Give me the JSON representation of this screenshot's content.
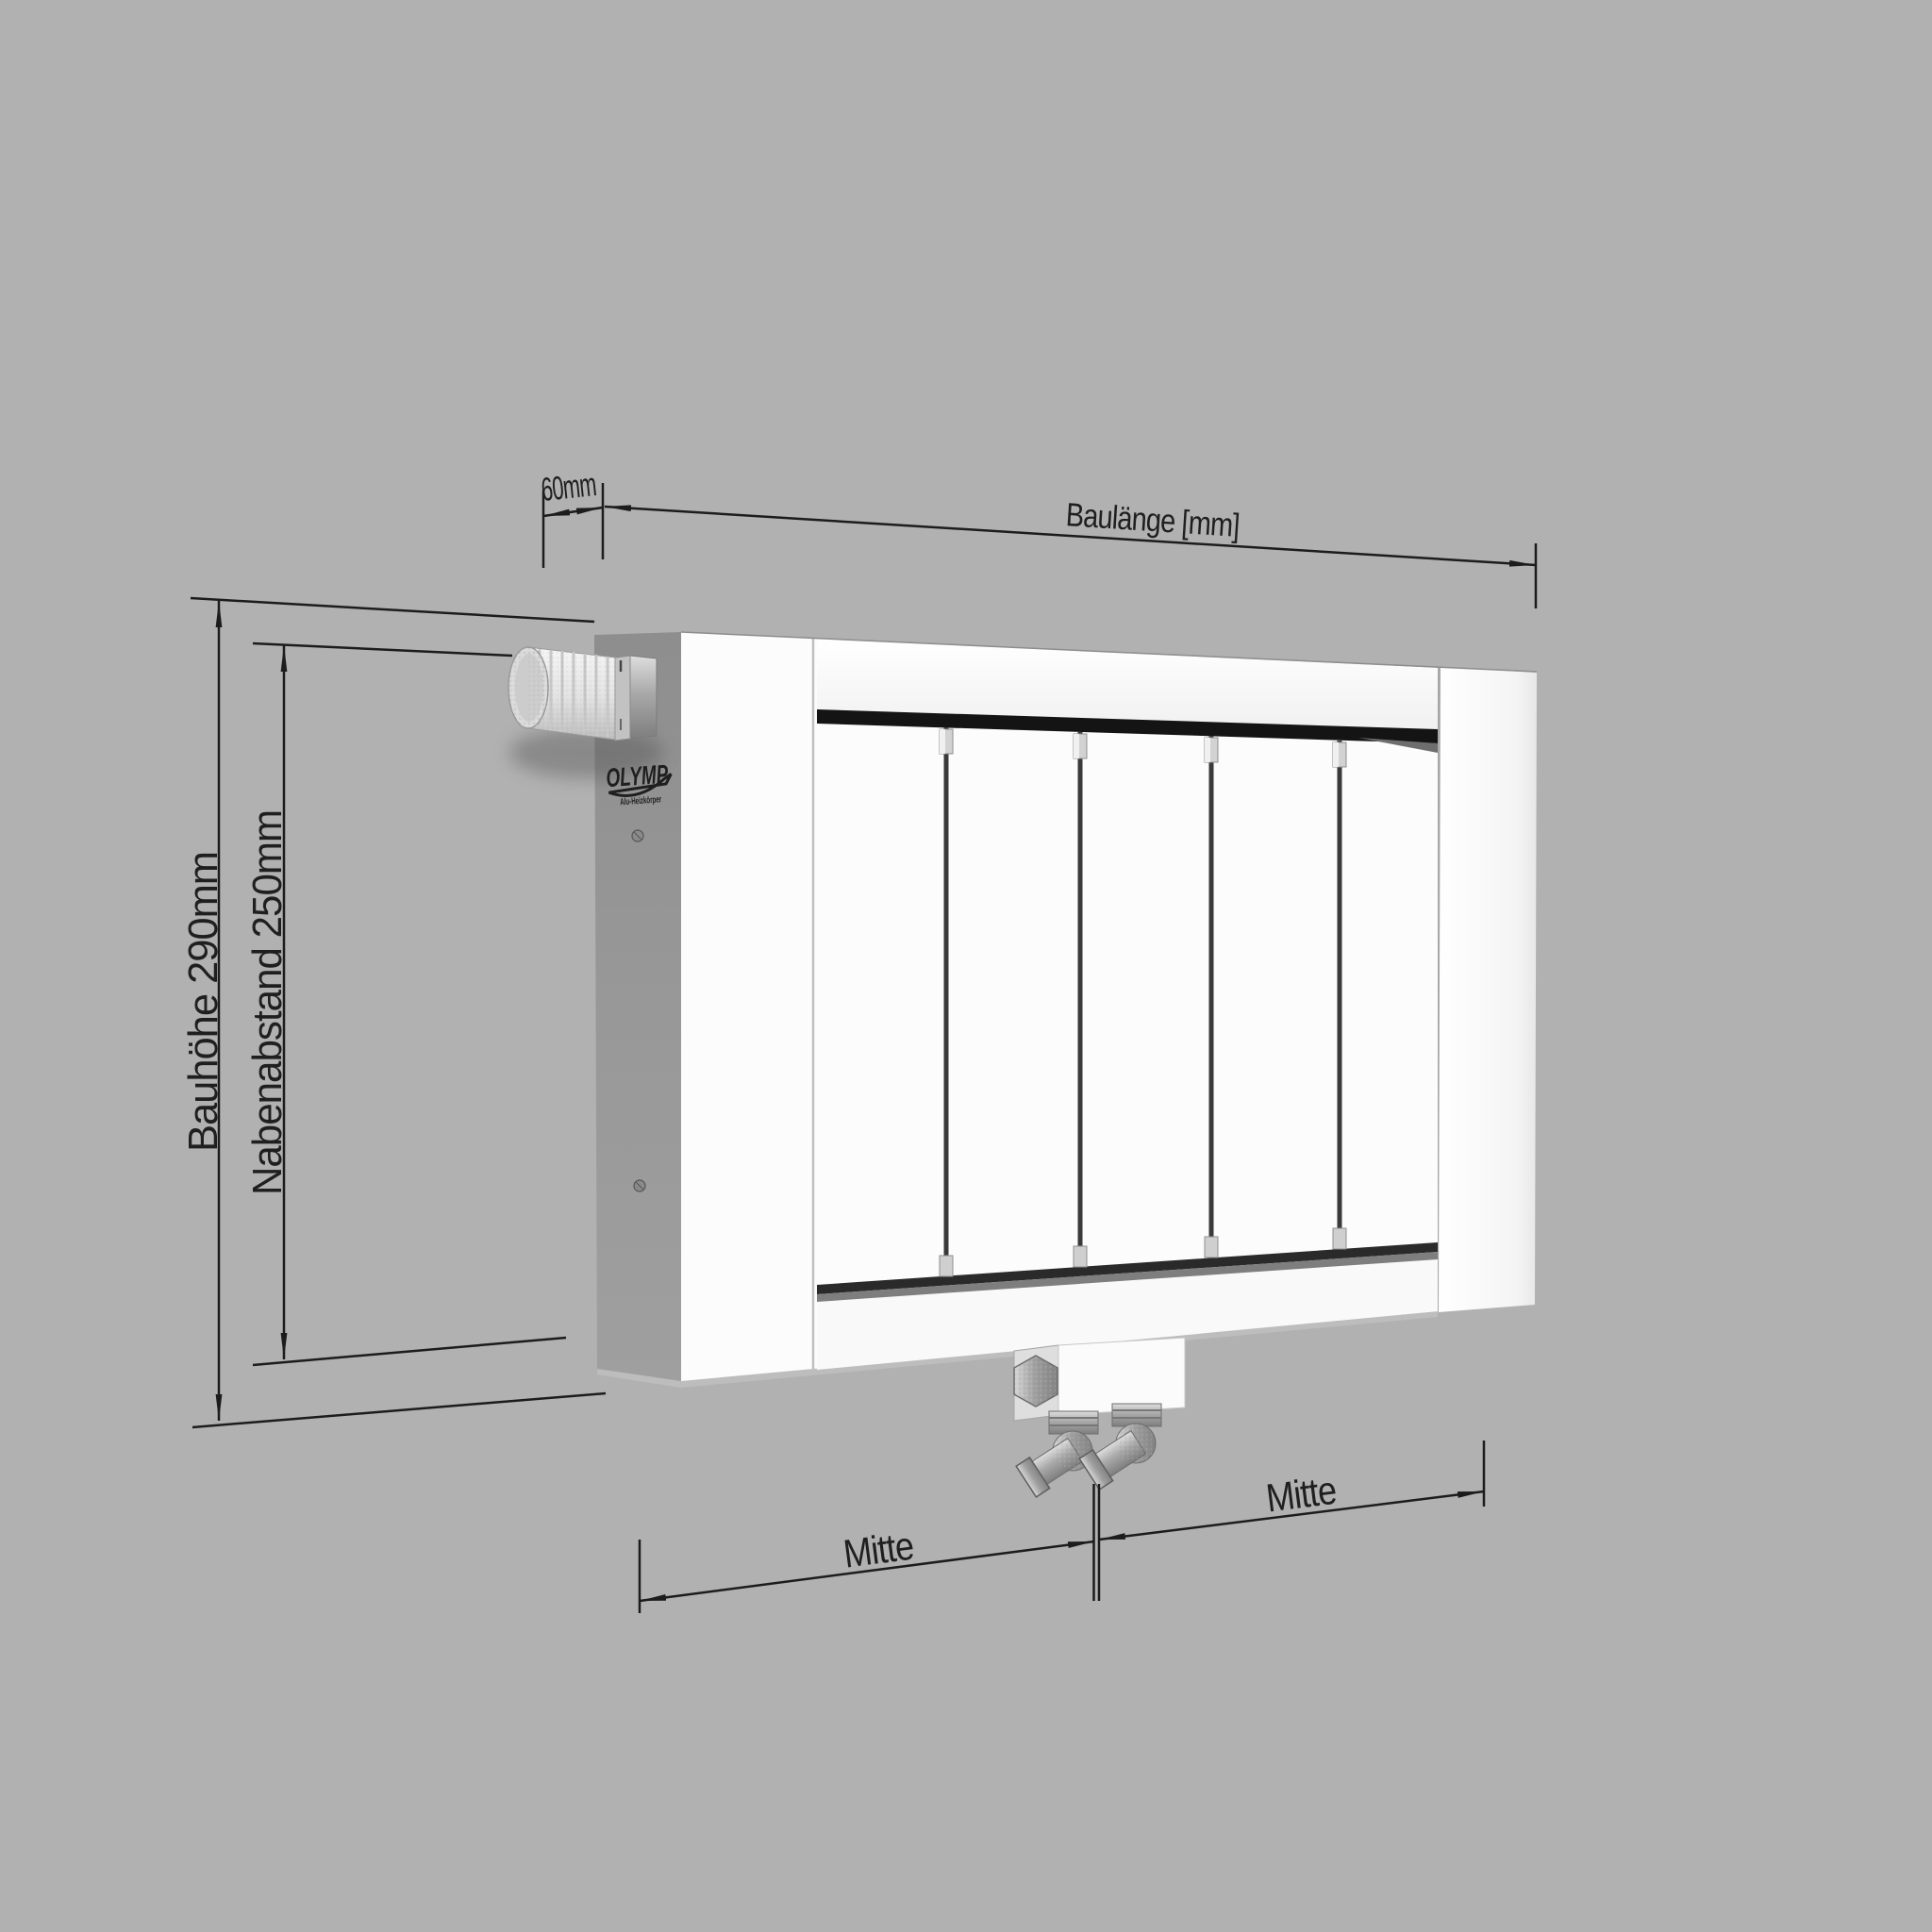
{
  "brand": {
    "name": "OLYMP",
    "tagline": "Alu-Heizkörper"
  },
  "dimensions": {
    "depth": {
      "label": "60mm",
      "value_mm": 60
    },
    "length": {
      "label": "Baulänge [mm]"
    },
    "height": {
      "label": "Bauhöhe 290mm",
      "value_mm": 290
    },
    "hub_spacing": {
      "label": "Nabenabstand 250mm",
      "value_mm": 250
    },
    "center_left": {
      "label": "Mitte"
    },
    "center_right": {
      "label": "Mitte"
    }
  },
  "colors": {
    "background": "#b1b1b1",
    "line": "#1c1c1c",
    "radiator_front": "#fcfcfc",
    "radiator_side": "#969696",
    "dark_band": "#141414"
  }
}
